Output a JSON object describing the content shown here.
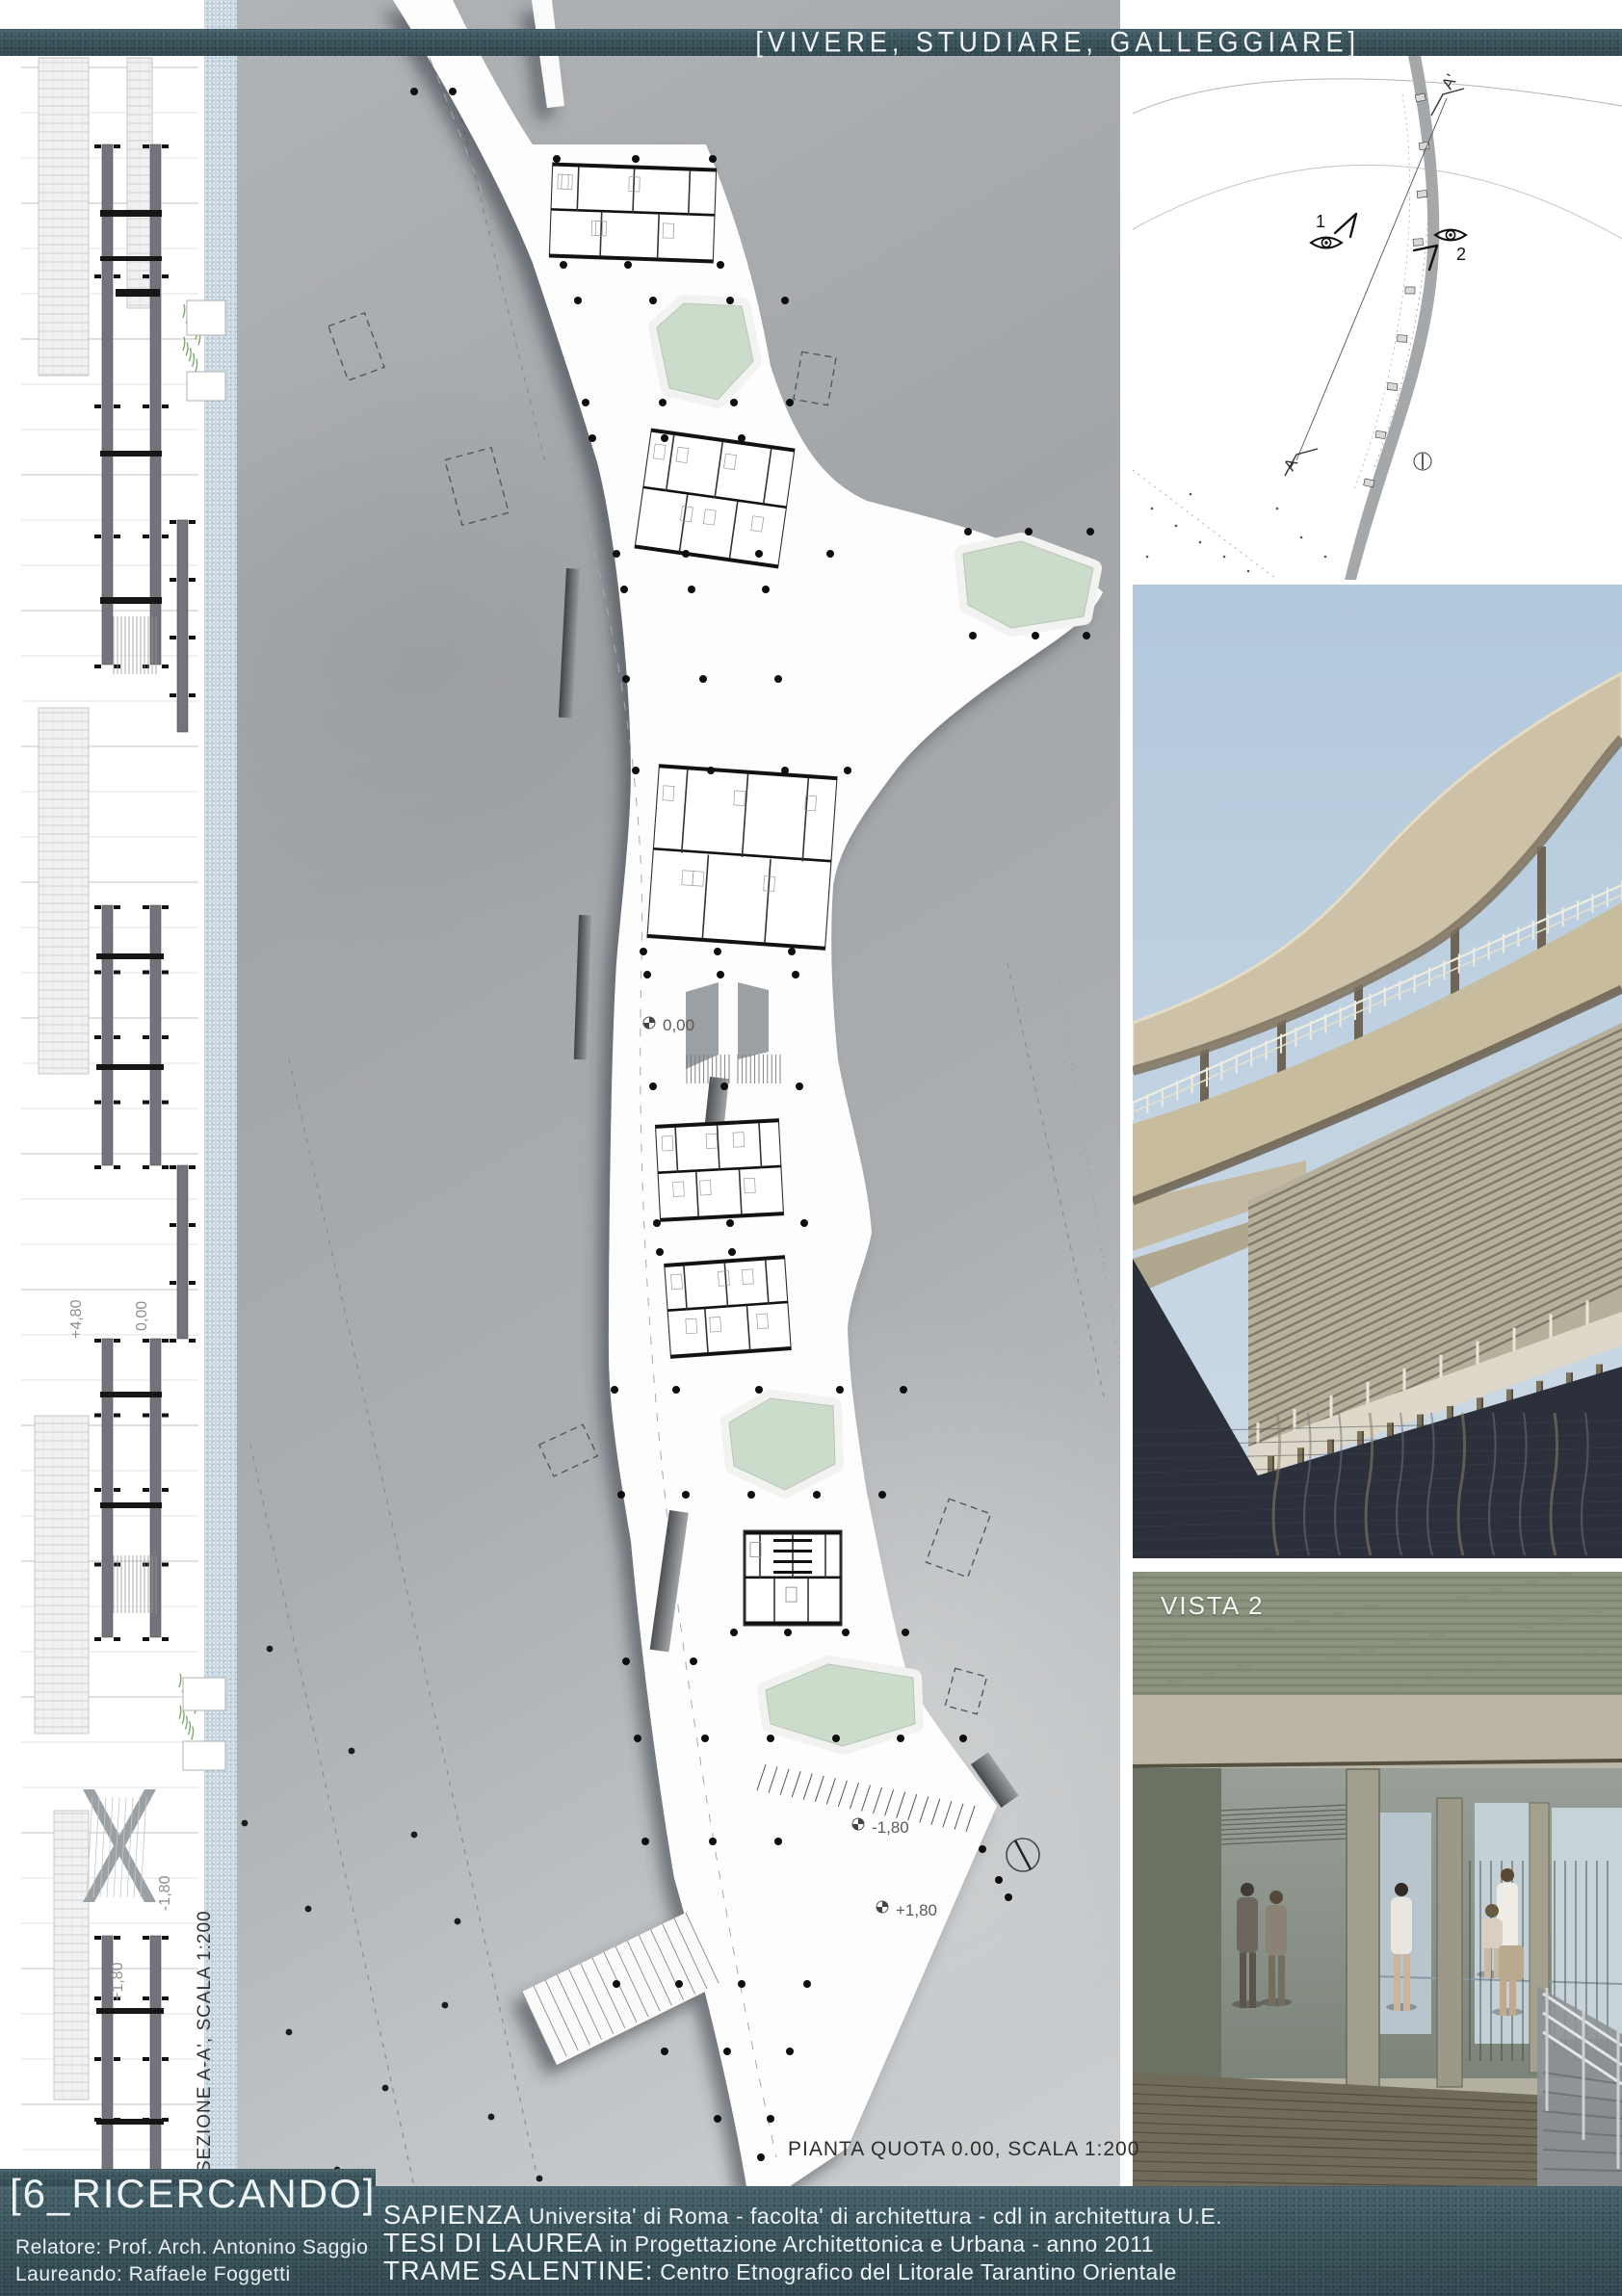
{
  "header": {
    "title": "[VIVERE, STUDIARE, GALLEGGIARE]"
  },
  "section": {
    "caption": "SEZIONE A-A', SCALA 1:200",
    "level_high": "+4,80",
    "level_zero": "0,00",
    "level_minus": "-1,80",
    "level_plus": "+1,80"
  },
  "plan": {
    "caption": "PIANTA QUOTA 0.00, SCALA 1:200",
    "level_zero": "0,00",
    "level_minus": "-1,80",
    "level_plus": "+1,80"
  },
  "site": {
    "view1": "1",
    "view2": "2",
    "section_start": "A",
    "section_end": "A'"
  },
  "vistas": {
    "vista1": "VISTA 1",
    "vista2": "VISTA 2"
  },
  "footer": {
    "chapter": "[6_RICERCANDO]",
    "advisor": "Relatore: Prof. Arch. Antonino Saggio",
    "student": "Laureando: Raffaele Foggetti",
    "uni_strong": "SAPIENZA",
    "uni_rest": " Universita' di Roma - facolta' di architettura - cdl in architettura U.E.",
    "thesis_strong": "TESI DI LAUREA",
    "thesis_rest": " in Progettazione Architettonica e Urbana - anno 2011",
    "project_strong": "TRAME SALENTINE:",
    "project_rest": " Centro Etnografico del Litorale Tarantino Orientale"
  },
  "colors": {
    "band_teal": "#3c565e",
    "panel_gray": "#aaadb0",
    "strip_blue": "#c7d6e0",
    "pool_green": "#ccdccb",
    "sky_blue": "#b5cadd",
    "water_dark": "#2b303b",
    "text_light": "#f2f4f4"
  }
}
